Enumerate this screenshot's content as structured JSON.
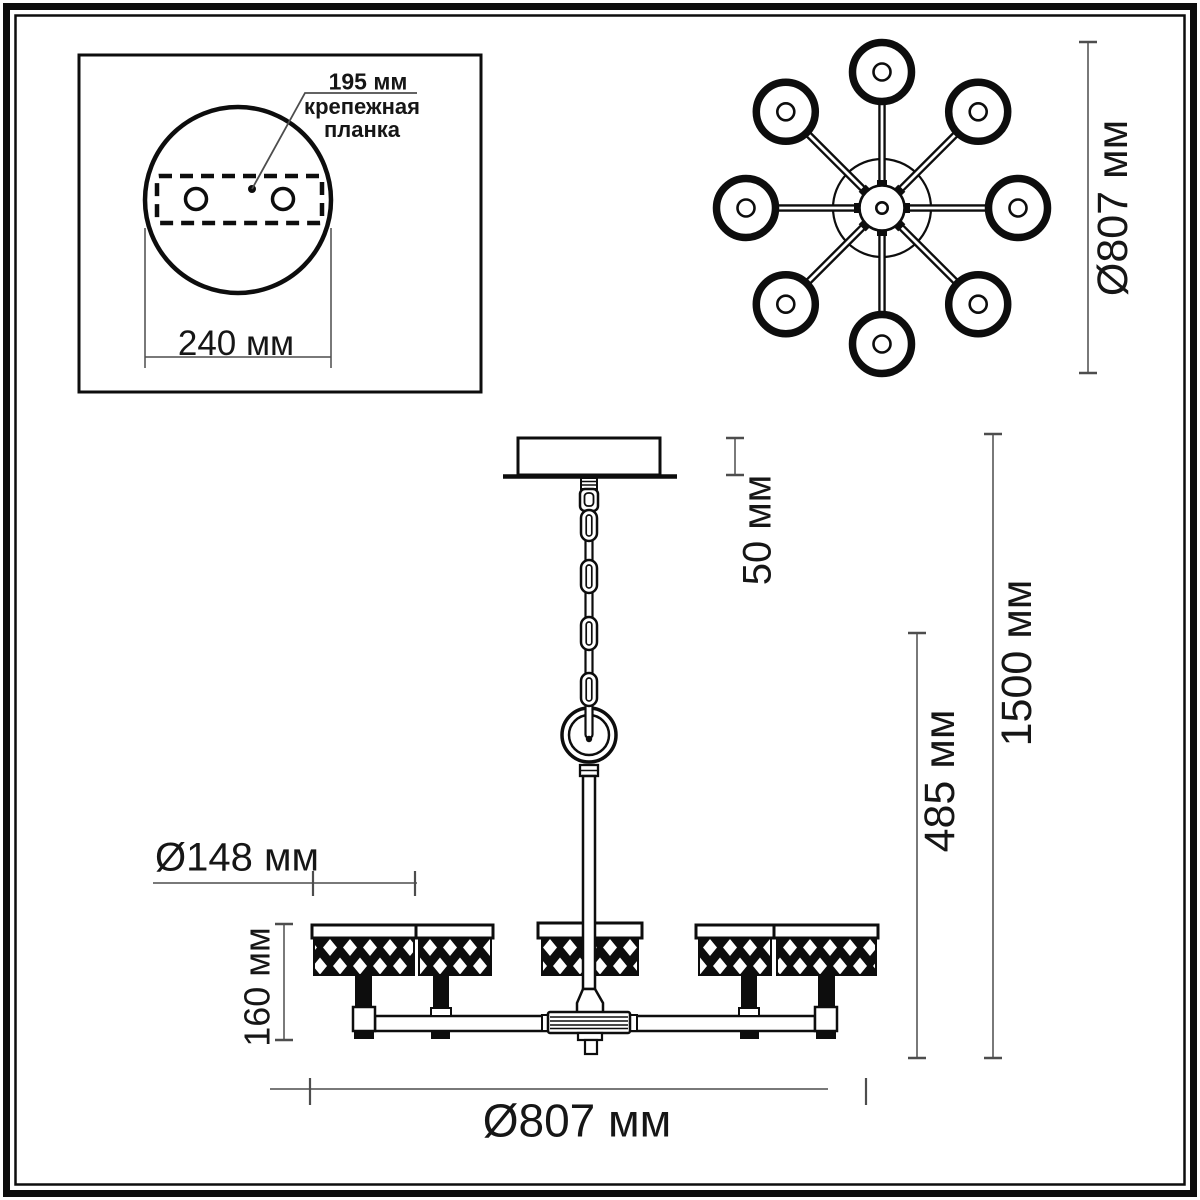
{
  "drawing": {
    "type": "chandelier-dimension-drawing",
    "colors": {
      "line": "#0d0d0d",
      "dimension_line": "#4d4d4d",
      "text": "#161616",
      "background": "#ffffff"
    },
    "mounting_panel": {
      "plate_offset_dim": "195 мм",
      "plate_label_line1": "крепежная",
      "plate_label_line2": "планка",
      "base_width_dim": "240 мм"
    },
    "top_view": {
      "lamp_count": 8,
      "diameter_dim": "Ø807 мм"
    },
    "side_view": {
      "canopy_height_dim": "50 мм",
      "total_height_dim": "1500 мм",
      "body_height_dim": "485 мм",
      "shade_height_dim": "160 мм",
      "shade_diameter_dim": "Ø148 мм",
      "diameter_dim": "Ø807 мм"
    }
  }
}
